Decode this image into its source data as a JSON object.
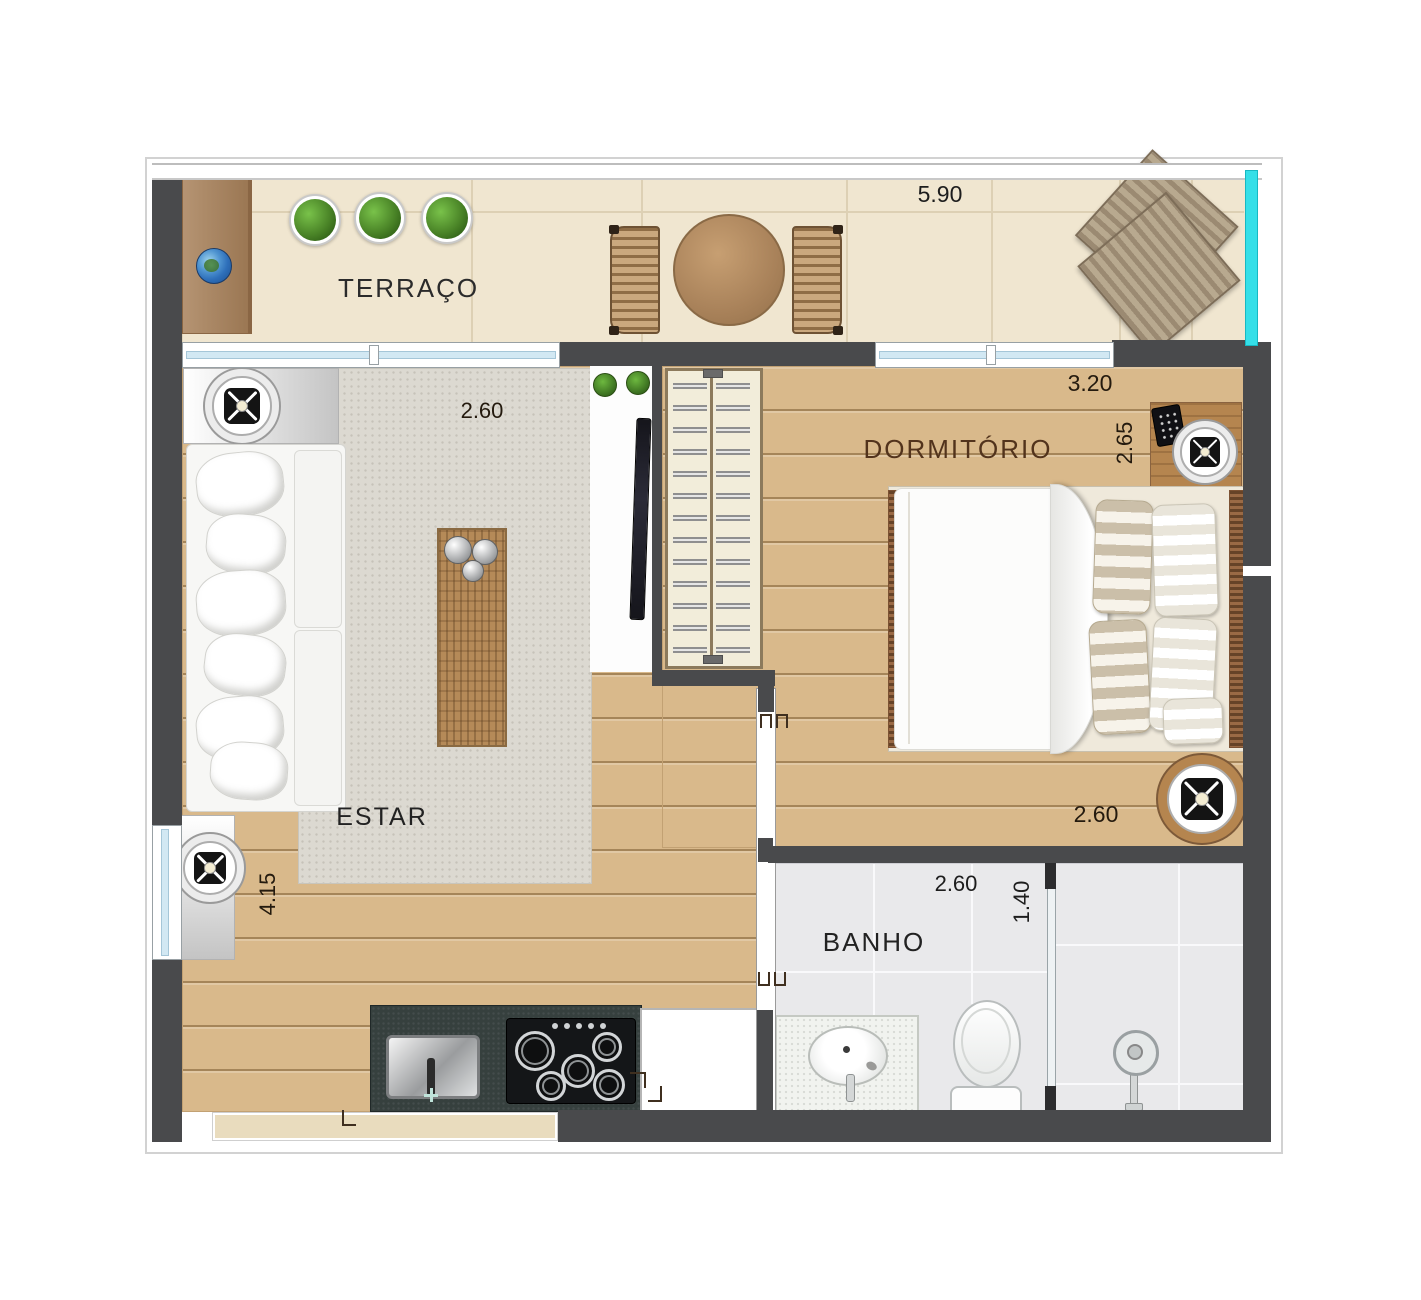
{
  "plan": {
    "rooms": {
      "terraco": {
        "label": "TERRAÇO",
        "width_m": "5.90"
      },
      "estar": {
        "label": "ESTAR",
        "width_m": "2.60",
        "depth_m": "4.15"
      },
      "cozinha": {
        "width_m": "3.20"
      },
      "dormitorio": {
        "label": "DORMITÓRIO",
        "width_m": "3.20",
        "depth_m": "2.65",
        "foot_width_m": "2.60"
      },
      "banho": {
        "label": "BANHO",
        "width_m": "2.60",
        "depth_m": "1.40"
      }
    },
    "colors": {
      "wall": "#494a4c",
      "wood_floor": "#d9b98b",
      "terrace_floor": "#f0e6d0",
      "rug": "#dcd9d1",
      "bath_tile": "#e9e9eb",
      "counter": "#36403e",
      "glass_railing": "#35dfe8"
    }
  }
}
